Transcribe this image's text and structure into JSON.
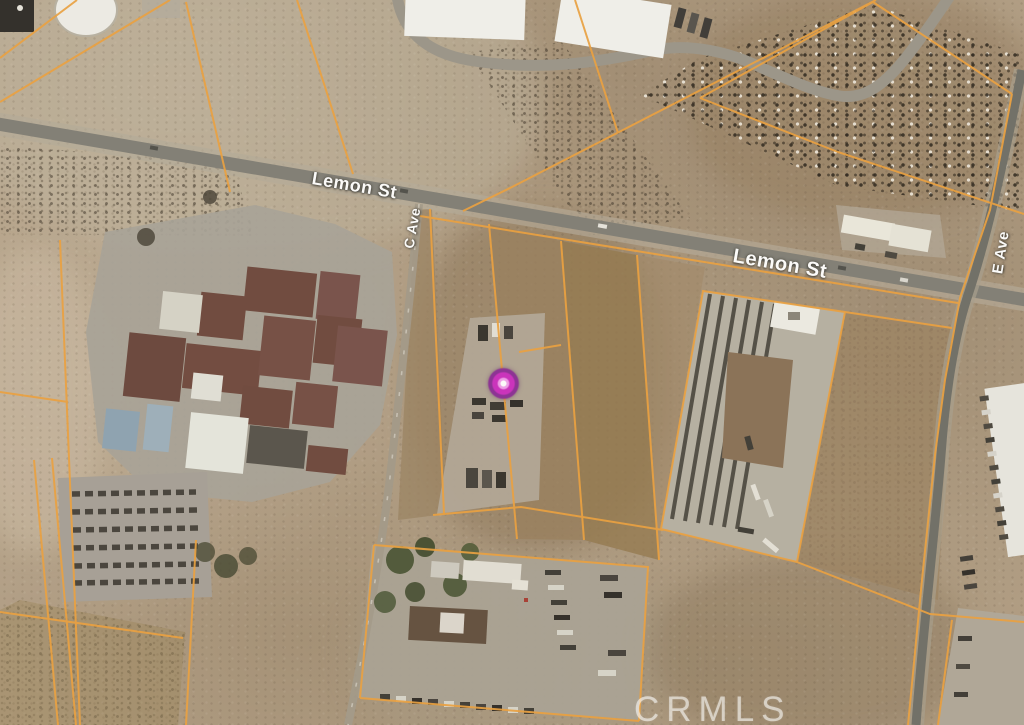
{
  "map": {
    "type": "satellite-parcel-map",
    "streets": {
      "lemon_st_upper": "Lemon St",
      "lemon_st_lower": "Lemon St",
      "c_ave": "C Ave",
      "e_ave": "E Ave"
    },
    "watermark": "CRMLS"
  },
  "colors": {
    "parcel_line": "#eda23f",
    "road_label": "#ffffff",
    "watermark_text": "rgba(255,255,255,0.58)",
    "marker_outer": "#8c2f96",
    "marker_mid": "#cc2fbf",
    "marker_inner": "#f2a0ec"
  }
}
